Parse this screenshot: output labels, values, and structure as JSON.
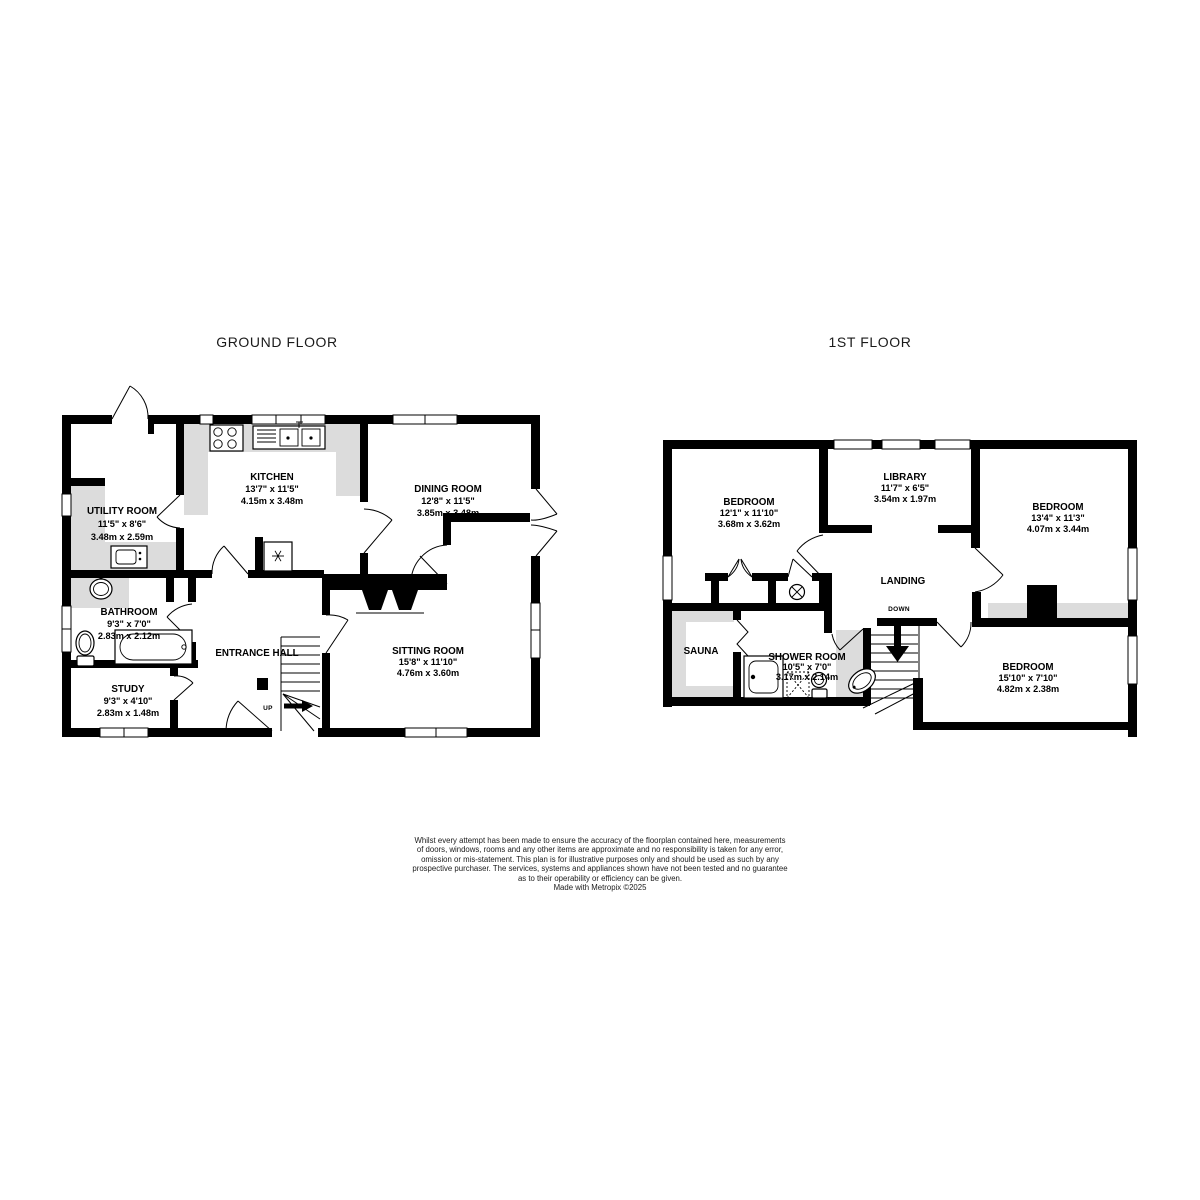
{
  "colors": {
    "wall": "#000000",
    "counter": "#dcdcdc",
    "background": "#ffffff"
  },
  "icons": {
    "freezer": "snowflake-in-box",
    "hot_water_cylinder": "circled-x",
    "stair_up_arrow": "right-arrow",
    "stair_down_arrow": "down-arrow"
  },
  "floors": [
    {
      "title": "GROUND FLOOR",
      "stair_label": "UP",
      "rooms": {
        "kitchen": {
          "name": "KITCHEN",
          "imperial": "13'7\" x 11'5\"",
          "metric": "4.15m x 3.48m"
        },
        "dining_room": {
          "name": "DINING ROOM",
          "imperial": "12'8\" x 11'5\"",
          "metric": "3.85m x 3.48m"
        },
        "utility_room": {
          "name": "UTILITY ROOM",
          "imperial": "11'5\" x 8'6\"",
          "metric": "3.48m x 2.59m"
        },
        "bathroom": {
          "name": "BATHROOM",
          "imperial": "9'3\" x 7'0\"",
          "metric": "2.83m x 2.12m"
        },
        "study": {
          "name": "STUDY",
          "imperial": "9'3\" x 4'10\"",
          "metric": "2.83m x 1.48m"
        },
        "entrance_hall": {
          "name": "ENTRANCE HALL"
        },
        "sitting_room": {
          "name": "SITTING ROOM",
          "imperial": "15'8\" x 11'10\"",
          "metric": "4.76m x 3.60m"
        }
      }
    },
    {
      "title": "1ST FLOOR",
      "stair_label": "DOWN",
      "rooms": {
        "bedroom_left": {
          "name": "BEDROOM",
          "imperial": "12'1\" x 11'10\"",
          "metric": "3.68m x 3.62m"
        },
        "library": {
          "name": "LIBRARY",
          "imperial": "11'7\" x 6'5\"",
          "metric": "3.54m x 1.97m"
        },
        "bedroom_right": {
          "name": "BEDROOM",
          "imperial": "13'4\" x 11'3\"",
          "metric": "4.07m x 3.44m"
        },
        "landing": {
          "name": "LANDING"
        },
        "sauna": {
          "name": "SAUNA"
        },
        "shower_room": {
          "name": "SHOWER ROOM",
          "imperial": "10'5\" x 7'0\"",
          "metric": "3.17m x 2.14m"
        },
        "bedroom_bottom": {
          "name": "BEDROOM",
          "imperial": "15'10\" x 7'10\"",
          "metric": "4.82m x 2.38m"
        }
      }
    }
  ],
  "disclaimer": {
    "lines": [
      "Whilst every attempt has been made to ensure the accuracy of the floorplan contained here, measurements",
      "of doors, windows, rooms and any other items are approximate and no responsibility is taken for any error,",
      "omission or mis-statement. This plan is for illustrative purposes only and should be used as such by any",
      "prospective purchaser. The services, systems and appliances shown have not been tested and no guarantee",
      "as to their operability or efficiency can be given.",
      "Made with Metropix ©2025"
    ]
  }
}
